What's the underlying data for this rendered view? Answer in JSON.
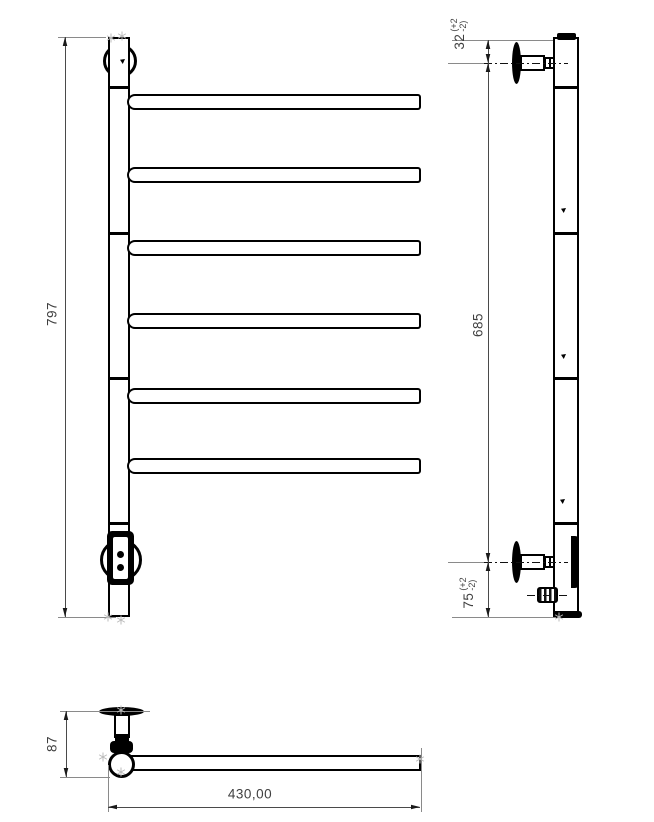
{
  "title": "towel-rail-technical-drawing",
  "colors": {
    "outline": "#000000",
    "dimension_line": "#4a4a4a",
    "extension_line": "#8a8a8a",
    "dimension_text": "#3f3f3f",
    "snap_marker": "#bcbcbc"
  },
  "views": {
    "front": {
      "label": "front-view"
    },
    "side": {
      "label": "side-view"
    },
    "top": {
      "label": "top-view"
    }
  },
  "dimensions": {
    "front_height": "797",
    "side_top_offset": {
      "value": "32",
      "tol_plus": "(+2",
      "tol_minus": "-2)"
    },
    "side_span": "685",
    "side_bottom_offset": {
      "value": "75",
      "tol_plus": "(+2",
      "tol_minus": "-2)"
    },
    "top_depth": "87",
    "top_width": "430,00"
  }
}
